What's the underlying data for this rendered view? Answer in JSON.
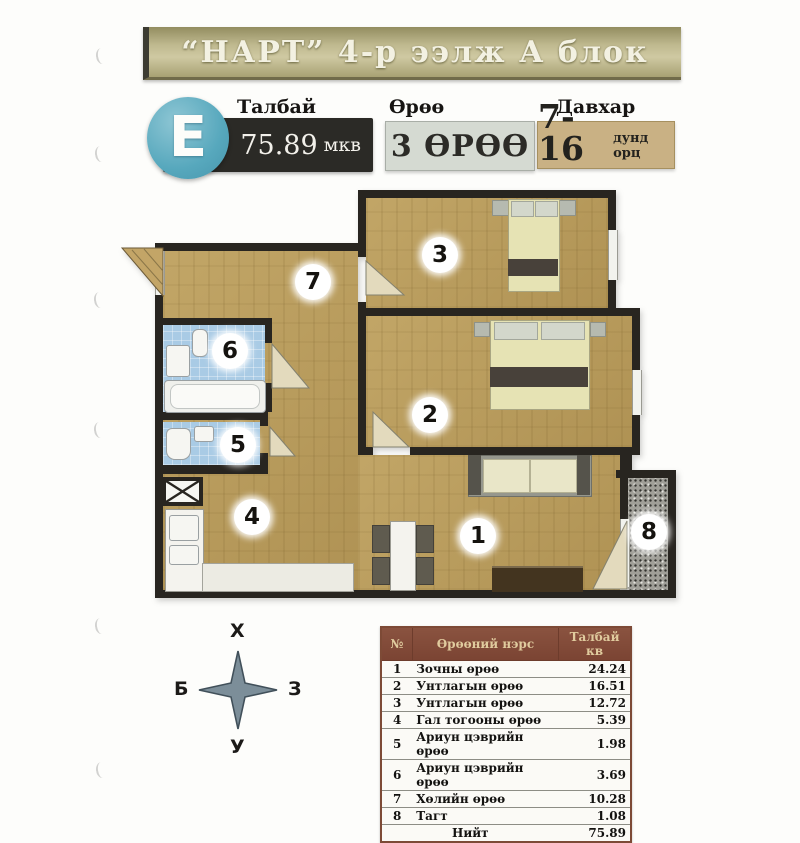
{
  "banner": {
    "title": "“НАРТ” 4-р ээлж А блок"
  },
  "info_panel": {
    "badge_letter": "E",
    "area": {
      "label": "Талбай",
      "value": "75.89",
      "unit": "мкв"
    },
    "rooms": {
      "label": "Өрөө",
      "value": "3 ӨРӨӨ"
    },
    "floor": {
      "label": "Давхар",
      "value": "7-16",
      "note": "дунд орц"
    }
  },
  "plan": {
    "room_markers": [
      "1",
      "2",
      "3",
      "4",
      "5",
      "6",
      "7",
      "8"
    ]
  },
  "compass": {
    "top": "Х",
    "right": "З",
    "bottom": "У",
    "left": "Б"
  },
  "area_table": {
    "headers": [
      "№",
      "Өрөөний нэрс",
      "Талбай кв"
    ],
    "rows": [
      {
        "no": "1",
        "name": "Зочны өрөө",
        "area": "24.24"
      },
      {
        "no": "2",
        "name": "Унтлагын өрөө",
        "area": "16.51"
      },
      {
        "no": "3",
        "name": "Унтлагын өрөө",
        "area": "12.72"
      },
      {
        "no": "4",
        "name": "Гал тогооны өрөө",
        "area": "5.39"
      },
      {
        "no": "5",
        "name": "Ариун цэврийн өрөө",
        "area": "1.98"
      },
      {
        "no": "6",
        "name": "Ариун цэврийн өрөө",
        "area": "3.69"
      },
      {
        "no": "7",
        "name": "Хөлийн өрөө",
        "area": "10.28"
      },
      {
        "no": "8",
        "name": "Тагт",
        "area": "1.08"
      }
    ],
    "total": {
      "label": "Нийт",
      "value": "75.89"
    }
  },
  "colors": {
    "banner_gold": "#beb88e",
    "badge_teal": "#57a8bd",
    "info_black_bar": "#2b2a26",
    "info_gray_bar": "#d5dad2",
    "info_tan_bar": "#c9b184",
    "wall_dark": "#282520",
    "floor_wood": "#b99c5c",
    "bathroom_blue": "#a9cbe5",
    "balcony_gray": "#a09f98",
    "table_header_maroon": "#7b4433"
  }
}
